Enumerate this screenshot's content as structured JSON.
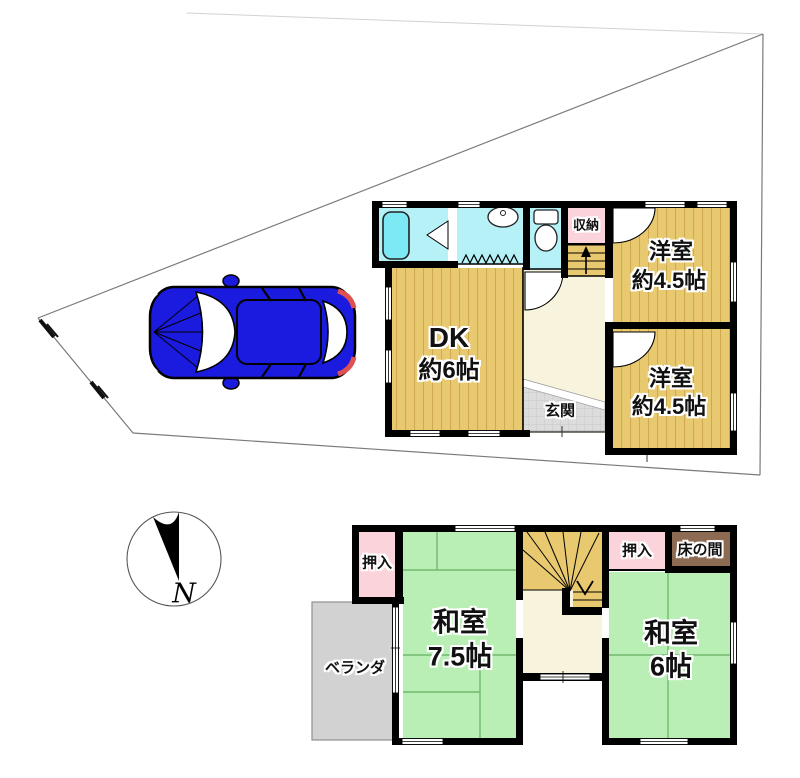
{
  "compass": {
    "north_label": "N"
  },
  "floor1": {
    "dk": {
      "label": "DK",
      "size": "約6帖"
    },
    "western_room_1": {
      "label": "洋室",
      "size": "約4.5帖"
    },
    "western_room_2": {
      "label": "洋室",
      "size": "約4.5帖"
    },
    "entrance": {
      "label": "玄関"
    },
    "storage": {
      "label": "収納"
    }
  },
  "floor2": {
    "japanese_room_75": {
      "label": "和室",
      "size": "7.5帖"
    },
    "japanese_room_6": {
      "label": "和室",
      "size": "6帖"
    },
    "closet_left": {
      "label": "押入"
    },
    "closet_right": {
      "label": "押入"
    },
    "tokonoma": {
      "label": "床の間"
    },
    "veranda": {
      "label": "ベランダ"
    }
  },
  "colors": {
    "wood_floor": "#e8c96f",
    "wood_stripe": "#cfa952",
    "tatami_green": "#b9efb4",
    "tatami_line": "#72b86e",
    "bath_cyan": "#b5f1f7",
    "bathtub_cyan": "#7de9f4",
    "closet_pink": "#fad4da",
    "tokonoma_brown": "#8d6b52",
    "hall_cream": "#f8f3dc",
    "entrance_tile": "#dcdcdc",
    "veranda_gray": "#d2d2d2",
    "car_blue": "#1b1be0",
    "taillight_red": "#e05050",
    "wall_black": "#000000",
    "lot_line_gray": "#7a7a7a"
  }
}
